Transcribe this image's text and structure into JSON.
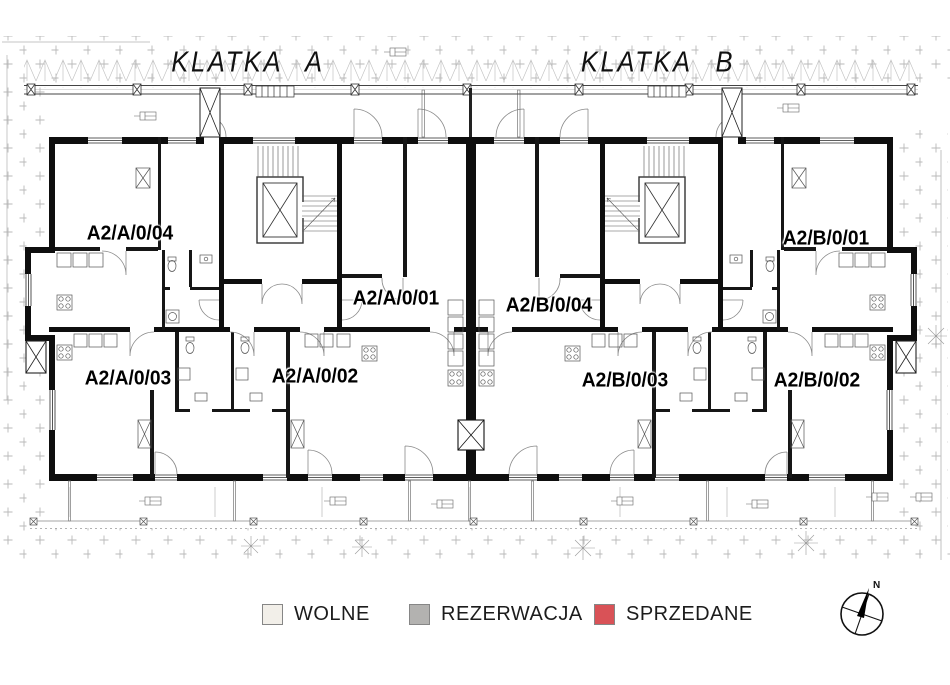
{
  "plan": {
    "sections": [
      {
        "label": "KLATKA A"
      },
      {
        "label": "KLATKA B"
      }
    ],
    "apartments": [
      {
        "id": "A2/A/0/04"
      },
      {
        "id": "A2/A/0/01"
      },
      {
        "id": "A2/B/0/04"
      },
      {
        "id": "A2/B/0/01"
      },
      {
        "id": "A2/A/0/03"
      },
      {
        "id": "A2/A/0/02"
      },
      {
        "id": "A2/B/0/03"
      },
      {
        "id": "A2/B/0/02"
      }
    ]
  },
  "legend": {
    "items": [
      {
        "label": "WOLNE",
        "color": "#f2efe9"
      },
      {
        "label": "REZERWACJA",
        "color": "#b3b2b0"
      },
      {
        "label": "SPRZEDANE",
        "color": "#d95257"
      }
    ]
  },
  "compass": {
    "label": "N"
  }
}
